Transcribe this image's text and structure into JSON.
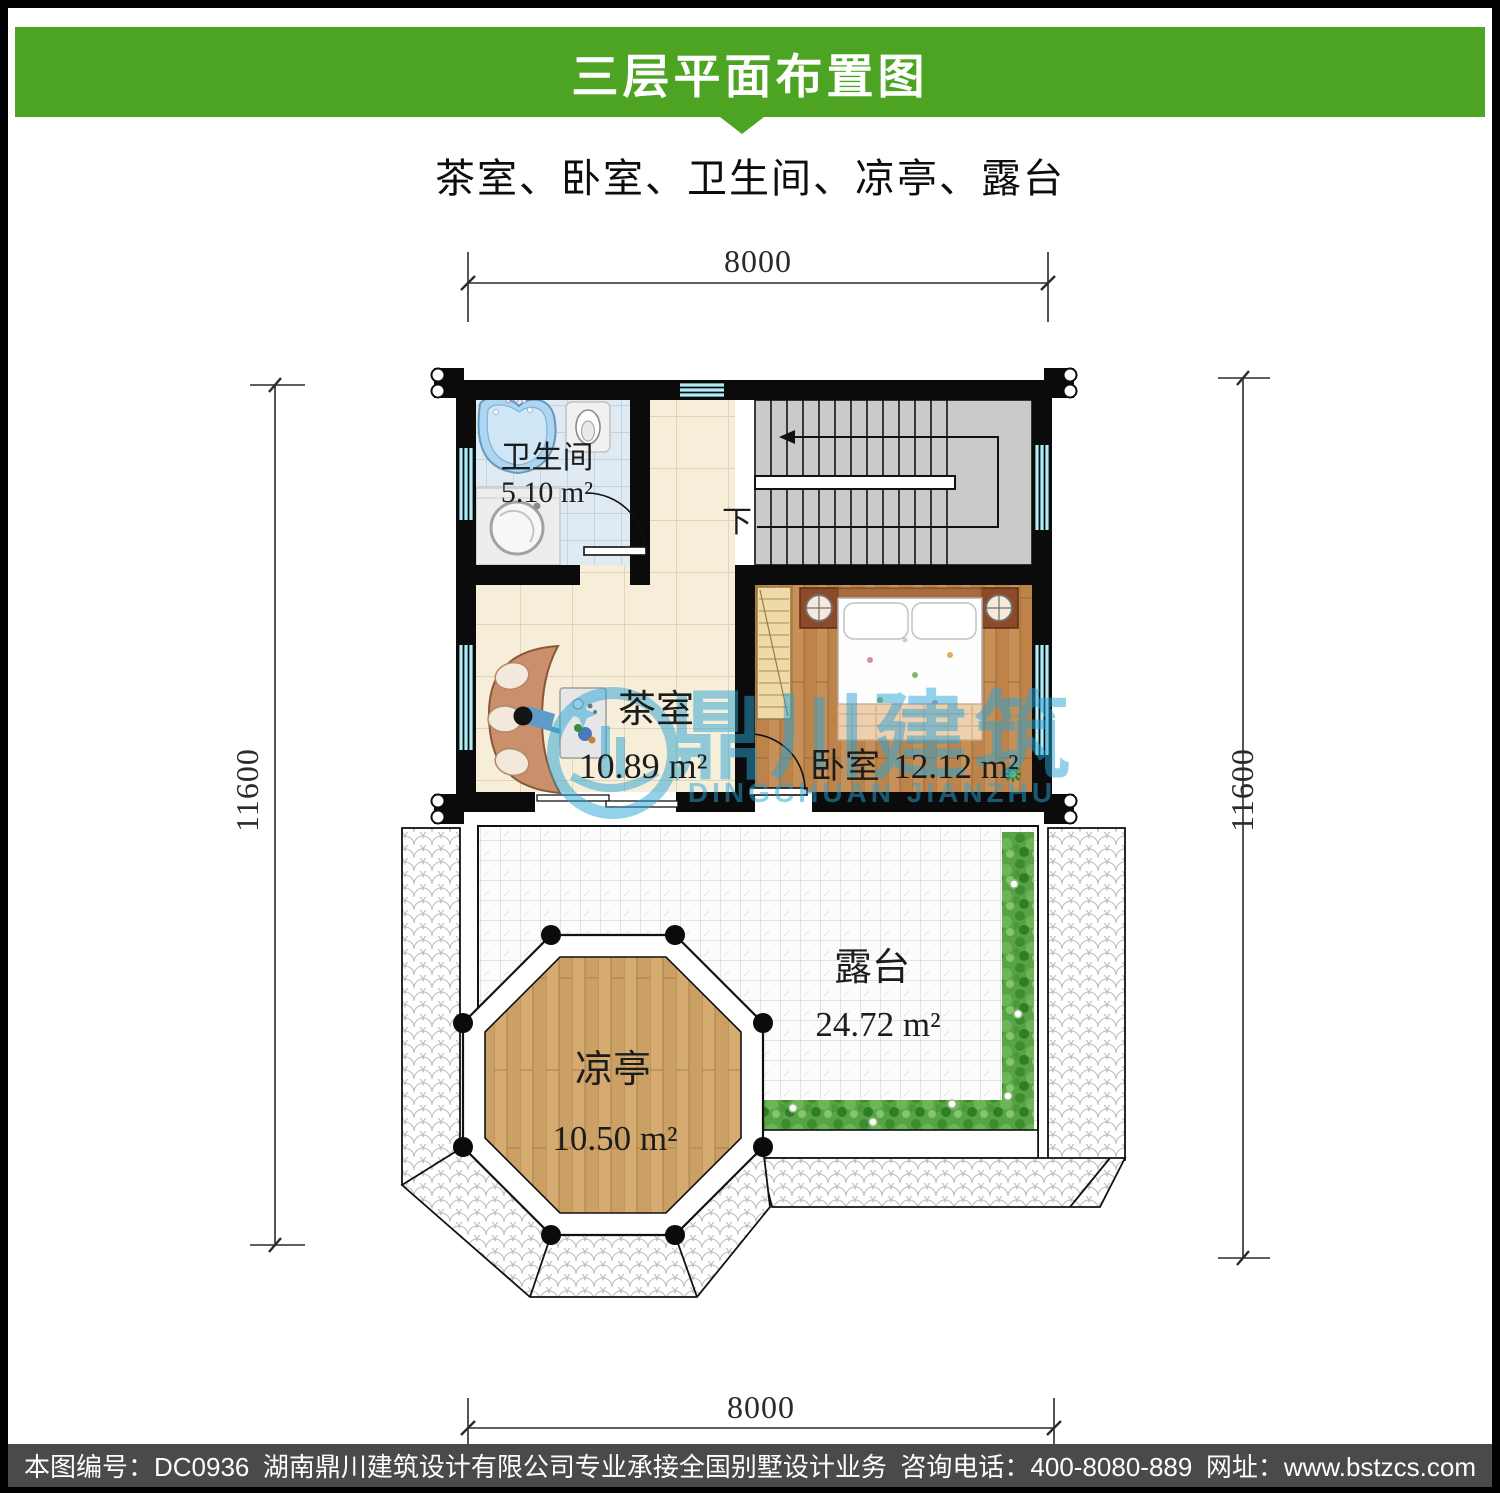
{
  "header": {
    "title": "三层平面布置图",
    "accent_color": "#4DA422"
  },
  "subtitle": "茶室、卧室、卫生间、凉亭、露台",
  "plan": {
    "dimensions": {
      "top": "8000",
      "bottom": "8000",
      "left": "11600",
      "right": "11600"
    },
    "rooms": {
      "bathroom": {
        "name": "卫生间",
        "area": "5.10 m²"
      },
      "tea_room": {
        "name": "茶室",
        "area": "10.89 m²"
      },
      "bedroom": {
        "name": "卧室",
        "area": "12.12 m²"
      },
      "terrace": {
        "name": "露台",
        "area": "24.72 m²"
      },
      "pavilion": {
        "name": "凉亭",
        "area": "10.50 m²"
      },
      "stairs": {
        "down_label": "下"
      }
    },
    "watermark": {
      "cn": "鼎川建筑",
      "en": "DINGCHUAN JIANZHU",
      "color": "#2aa4d6"
    }
  },
  "footer": {
    "drawing_no": "本图编号：DC0936",
    "company": "湖南鼎川建筑设计有限公司专业承接全国别墅设计业务",
    "phone": "咨询电话：400-8080-889",
    "website": "网址：www.bstzcs.com",
    "bg_color": "#4a4a4a"
  }
}
